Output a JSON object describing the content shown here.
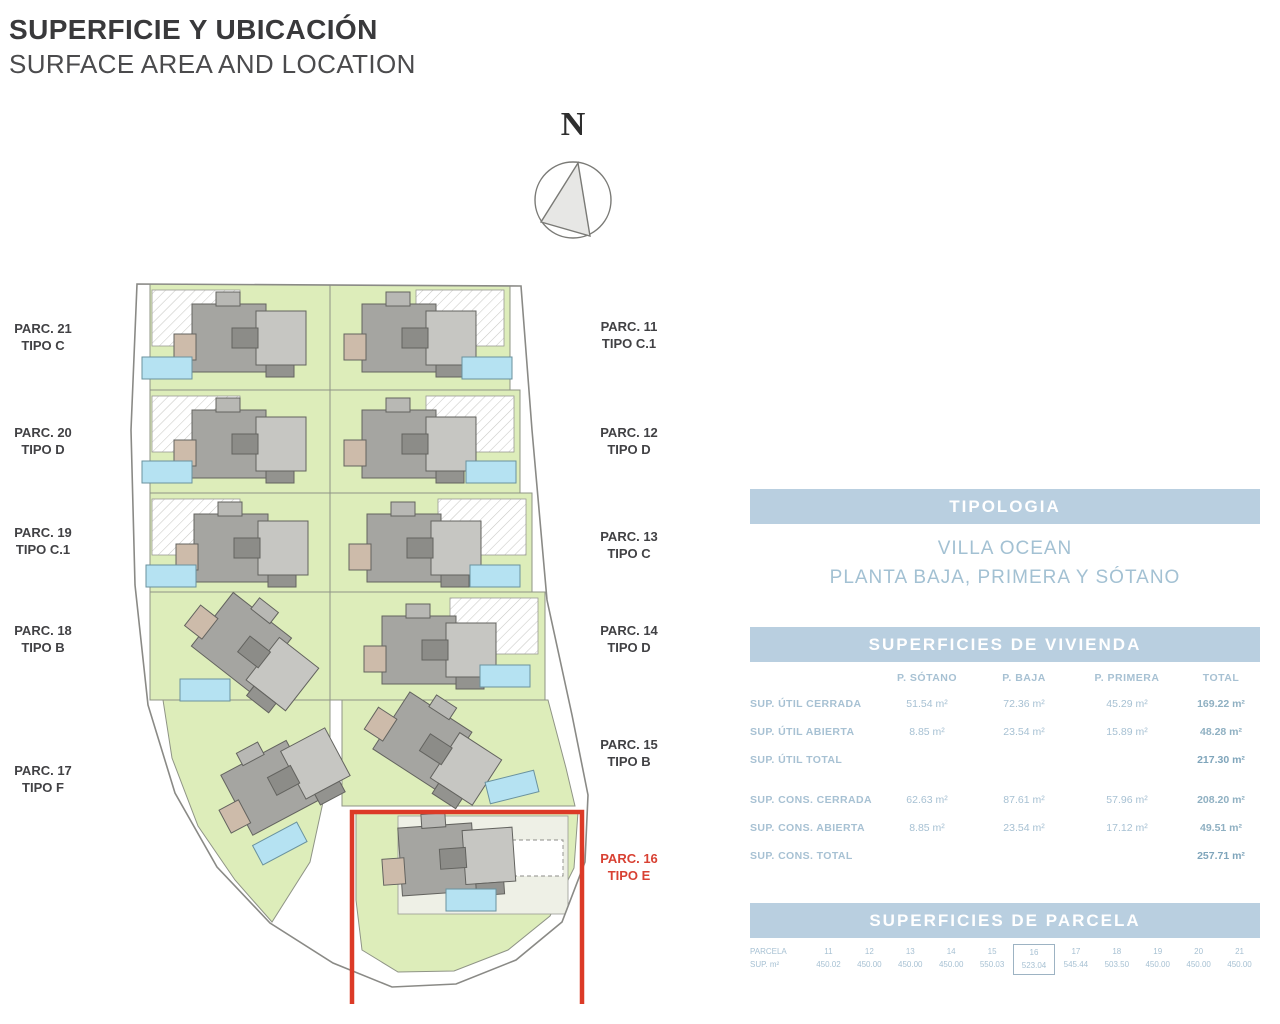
{
  "header": {
    "title_es": "SUPERFICIE Y UBICACIÓN",
    "title_en": "SURFACE AREA AND LOCATION"
  },
  "compass": {
    "north_label": "N"
  },
  "site_plan": {
    "left_labels": [
      {
        "parc": "PARC. 21",
        "tipo": "TIPO C"
      },
      {
        "parc": "PARC. 20",
        "tipo": "TIPO D"
      },
      {
        "parc": "PARC. 19",
        "tipo": "TIPO C.1"
      },
      {
        "parc": "PARC. 18",
        "tipo": "TIPO B"
      },
      {
        "parc": "PARC. 17",
        "tipo": "TIPO F"
      }
    ],
    "right_labels": [
      {
        "parc": "PARC. 11",
        "tipo": "TIPO C.1"
      },
      {
        "parc": "PARC. 12",
        "tipo": "TIPO D"
      },
      {
        "parc": "PARC. 13",
        "tipo": "TIPO C"
      },
      {
        "parc": "PARC. 14",
        "tipo": "TIPO D"
      },
      {
        "parc": "PARC. 15",
        "tipo": "TIPO B"
      }
    ],
    "highlighted_label": {
      "parc": "PARC. 16",
      "tipo": "TIPO E"
    }
  },
  "tipologia": {
    "header": "TIPOLOGIA",
    "line1": "VILLA OCEAN",
    "line2": "PLANTA BAJA, PRIMERA Y SÓTANO"
  },
  "vivienda": {
    "header": "SUPERFICIES DE VIVIENDA",
    "columns": [
      "P. SÓTANO",
      "P. BAJA",
      "P. PRIMERA",
      "TOTAL"
    ],
    "rows": [
      {
        "label": "SUP. ÚTIL CERRADA",
        "values": [
          "51.54 m²",
          "72.36 m²",
          "45.29 m²",
          "169.22 m²"
        ]
      },
      {
        "label": "SUP. ÚTIL ABIERTA",
        "values": [
          "8.85 m²",
          "23.54 m²",
          "15.89 m²",
          "48.28 m²"
        ]
      },
      {
        "label": "SUP. ÚTIL TOTAL",
        "values": [
          "",
          "",
          "",
          "217.30 m²"
        ]
      },
      {
        "label": "SUP. CONS. CERRADA",
        "values": [
          "62.63 m²",
          "87.61 m²",
          "57.96 m²",
          "208.20 m²"
        ]
      },
      {
        "label": "SUP. CONS. ABIERTA",
        "values": [
          "8.85 m²",
          "23.54 m²",
          "17.12 m²",
          "49.51 m²"
        ]
      },
      {
        "label": "SUP. CONS. TOTAL",
        "values": [
          "",
          "",
          "",
          "257.71 m²"
        ]
      }
    ]
  },
  "parcela": {
    "header": "SUPERFICIES DE PARCELA",
    "row_label_num": "PARCELA",
    "row_label_sup": "SUP. m²",
    "columns": [
      {
        "num": "11",
        "sup": "450.02"
      },
      {
        "num": "12",
        "sup": "450.00"
      },
      {
        "num": "13",
        "sup": "450.00"
      },
      {
        "num": "14",
        "sup": "450.00"
      },
      {
        "num": "15",
        "sup": "550.03"
      },
      {
        "num": "16",
        "sup": "523.04"
      },
      {
        "num": "17",
        "sup": "545.44"
      },
      {
        "num": "18",
        "sup": "503.50"
      },
      {
        "num": "19",
        "sup": "450.00"
      },
      {
        "num": "20",
        "sup": "450.00"
      },
      {
        "num": "21",
        "sup": "450.00"
      }
    ],
    "highlighted_parcel": "16"
  },
  "colors": {
    "panel_bar": "#b9cfe0",
    "panel_text": "#a7c1d3",
    "highlight_red": "#dc3a27",
    "lawn_green": "#ddedba",
    "pool_blue": "#b5e2f2",
    "building_gray": "#a5a5a1"
  }
}
